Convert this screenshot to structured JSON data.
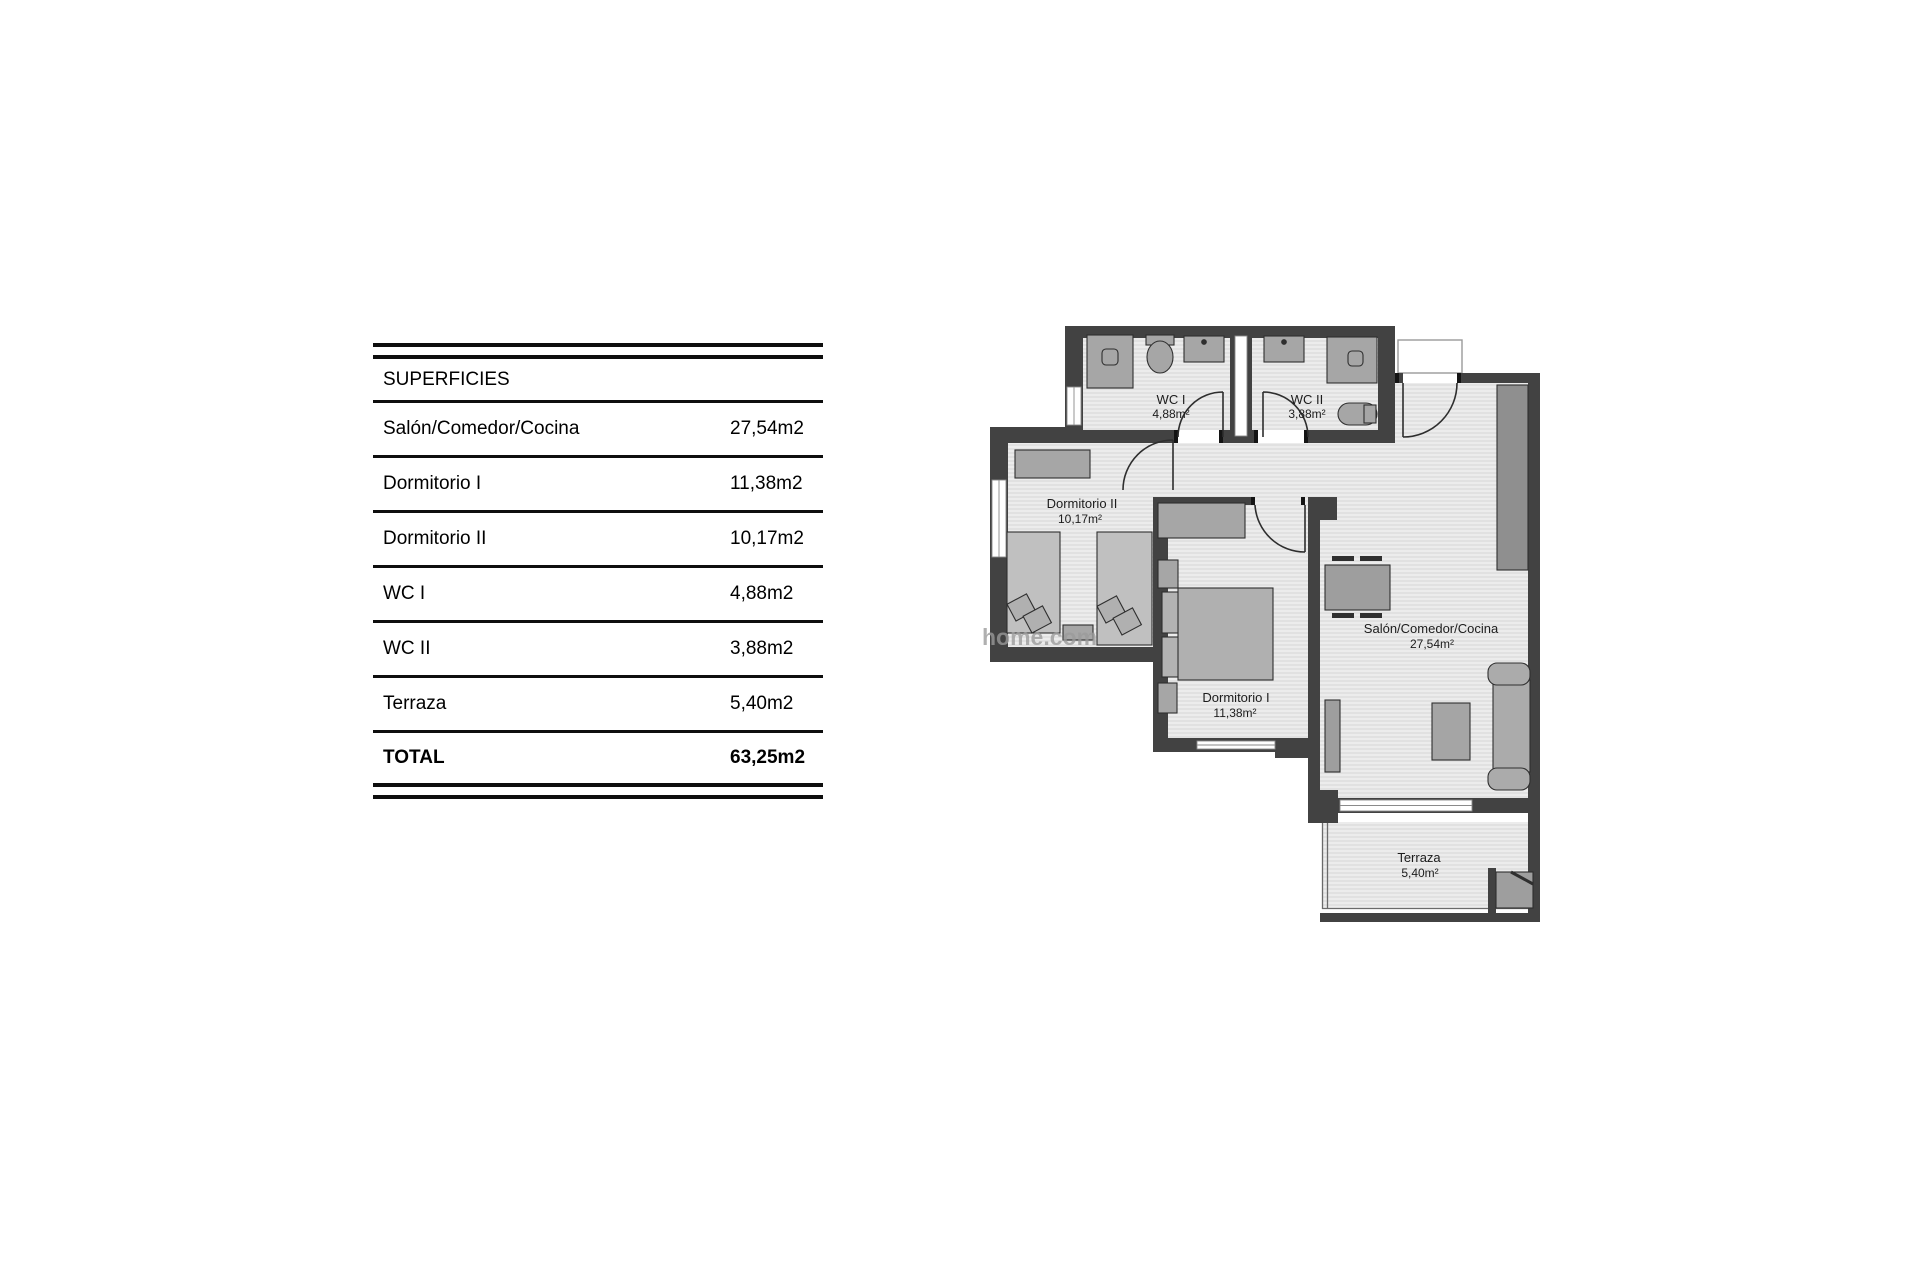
{
  "table": {
    "header": "SUPERFICIES",
    "rows": [
      {
        "label": "Salón/Comedor/Cocina",
        "value": "27,54m2"
      },
      {
        "label": "Dormitorio I",
        "value": "11,38m2"
      },
      {
        "label": "Dormitorio II",
        "value": "10,17m2"
      },
      {
        "label": "WC I",
        "value": "4,88m2"
      },
      {
        "label": "WC II",
        "value": "3,88m2"
      },
      {
        "label": "Terraza",
        "value": "5,40m2"
      }
    ],
    "total_label": "TOTAL",
    "total_value": "63,25m2"
  },
  "plan": {
    "rooms": [
      {
        "name": "WC I",
        "area": "4,88m²"
      },
      {
        "name": "WC II",
        "area": "3,88m²"
      },
      {
        "name": "Dormitorio II",
        "area": "10,17m²"
      },
      {
        "name": "Dormitorio I",
        "area": "11,38m²"
      },
      {
        "name": "Salón/Comedor/Cocina",
        "area": "27,54m²"
      },
      {
        "name": "Terraza",
        "area": "5,40m²"
      }
    ],
    "watermark": "home.com"
  },
  "colors": {
    "wall": "#424242",
    "floor": "#ececec",
    "floor_line": "#d8d8d8",
    "furniture": "#a6a6a6",
    "counter": "#8f8f8f"
  }
}
